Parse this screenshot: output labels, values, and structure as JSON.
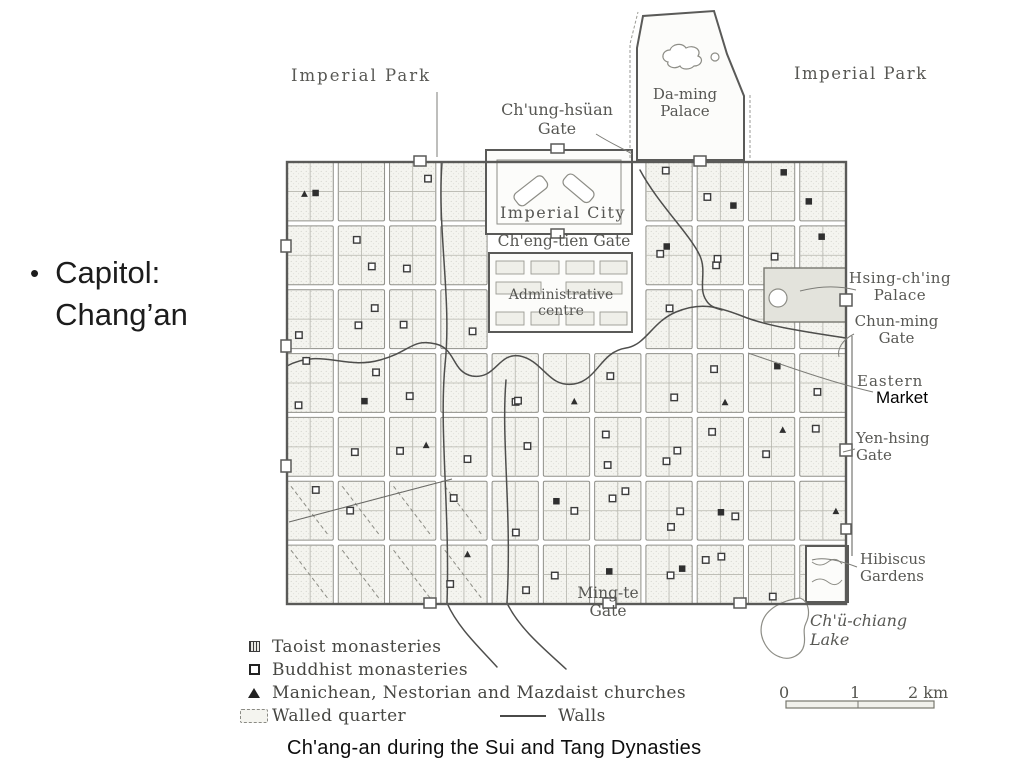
{
  "colors": {
    "map_ink": "#4a4a46",
    "annotation_black": "#000000"
  },
  "slide": {
    "bullet_char": "•",
    "bullet_text": "Capitol: Chang’an"
  },
  "map": {
    "caption": "Ch'ang-an during the Sui and Tang Dynasties",
    "labels": [
      {
        "id": "imperial-park-west",
        "text": "Imperial Park",
        "x": 291,
        "y": 66,
        "fs": 16.5,
        "ls": 2
      },
      {
        "id": "imperial-park-east",
        "text": "Imperial Park",
        "x": 794,
        "y": 64,
        "fs": 16.5,
        "ls": 1.5
      },
      {
        "id": "chung-hsuan-gate",
        "text": "Ch'ung-hsüan\nGate",
        "x": 477,
        "y": 101,
        "w": 160,
        "fs": 16
      },
      {
        "id": "da-ming-palace",
        "text": "Da-ming\nPalace",
        "x": 642,
        "y": 86,
        "w": 86,
        "fs": 15
      },
      {
        "id": "imperial-city",
        "text": "Imperial City",
        "x": 493,
        "y": 204,
        "w": 140,
        "fs": 16,
        "ls": 1.5
      },
      {
        "id": "cheng-tien-gate",
        "text": "Ch'eng-tien Gate",
        "x": 490,
        "y": 233,
        "w": 148,
        "fs": 15.5
      },
      {
        "id": "administrative-centre",
        "text": "Administrative\ncentre",
        "x": 487,
        "y": 287,
        "w": 148,
        "fs": 14
      },
      {
        "id": "hsing-ching-palace",
        "text": "Hsing-ch'ing\nPalace",
        "x": 844,
        "y": 270,
        "w": 112,
        "fs": 15,
        "ls": 0.5
      },
      {
        "id": "chun-ming-gate",
        "text": "Chun-ming\nGate",
        "x": 844,
        "y": 313,
        "w": 105,
        "fs": 15
      },
      {
        "id": "eastern-market-old",
        "text": "Eastern",
        "x": 857,
        "y": 373,
        "fs": 15,
        "ls": 1
      },
      {
        "id": "eastern-market-annotation",
        "text": "Market",
        "x": 876,
        "y": 388,
        "fs": 17,
        "cls": "annotation"
      },
      {
        "id": "yen-hsing-gate",
        "text": "Yen-hsing\nGate",
        "x": 856,
        "y": 430,
        "fs": 15
      },
      {
        "id": "hibiscus-gardens",
        "text": "Hibiscus\nGardens",
        "x": 860,
        "y": 551,
        "fs": 15
      },
      {
        "id": "chu-chiang-lake",
        "text": "Ch'ü-chiang\nLake",
        "x": 810,
        "y": 612,
        "fs": 16,
        "italic": true
      },
      {
        "id": "ming-te-gate",
        "text": "Ming-te\nGate",
        "x": 552,
        "y": 585,
        "w": 112,
        "fs": 15.5
      }
    ],
    "legend": {
      "items": [
        {
          "symbol": "taoist-square",
          "label": "Taoist monasteries"
        },
        {
          "symbol": "open-square",
          "label": "Buddhist monasteries"
        },
        {
          "symbol": "triangle",
          "label": "Manichean, Nestorian and Mazdaist churches"
        },
        {
          "symbol": "walled-quarter",
          "label": "Walled quarter"
        },
        {
          "symbol": "wall-line",
          "label": "Walls"
        }
      ]
    },
    "scale": {
      "ticks": [
        "0",
        "1",
        "2 km"
      ]
    }
  }
}
